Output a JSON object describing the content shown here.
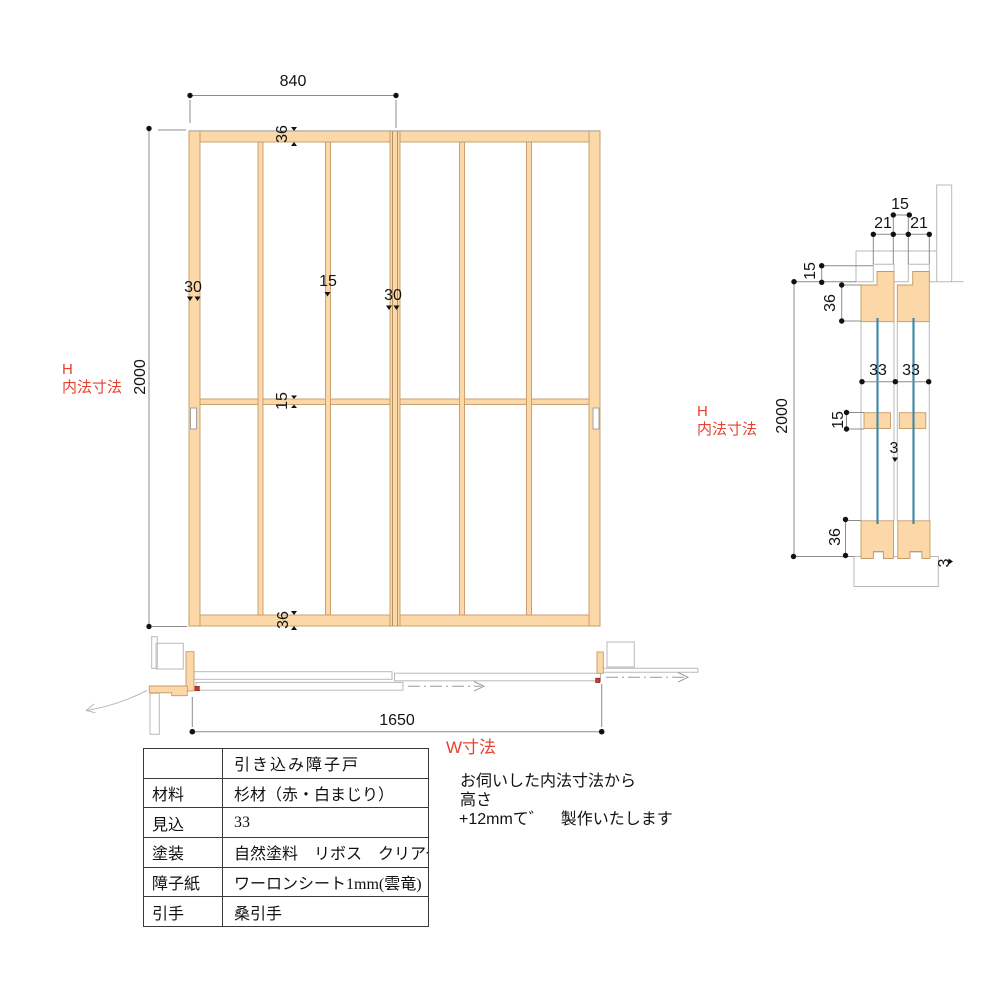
{
  "labels": {
    "h_left": {
      "line1": "H",
      "line2": "内法寸法"
    },
    "h_right": {
      "line1": "H",
      "line2": "内法寸法"
    },
    "w_label": "W寸法"
  },
  "elevation_dims": {
    "door_width": "840",
    "height": "2000",
    "top_rail": "36",
    "mid_rail": "15",
    "bottom_rail": "36",
    "left_stile": "30",
    "mullion": "15",
    "meeting_stile": "30"
  },
  "section_dims": {
    "track_gap_top": "15",
    "groove_left": "21",
    "groove_right": "21",
    "groove_depth": "15",
    "top_rail_height": "36",
    "door_thickness_left": "33",
    "door_thickness_right": "33",
    "height": "2000",
    "mid_rail_height": "15",
    "door_gap": "3",
    "bottom_rail_height": "36",
    "track_rail_height": "3"
  },
  "plan_dims": {
    "opening_width": "1650"
  },
  "note": {
    "line1": "お伺いした内法寸法から",
    "line2": "高さ",
    "line3": "+12mmて゛　製作いたします"
  },
  "spec_table": {
    "title": "引き込み障子戸",
    "rows": [
      {
        "label": "材料",
        "value": "杉材（赤・白まじり）"
      },
      {
        "label": "見込",
        "value": "33"
      },
      {
        "label": "塗装",
        "value": "自然塗料　リボス　クリアー"
      },
      {
        "label": "障子紙",
        "value": "ワーロンシート1mm(雲竜)"
      },
      {
        "label": "引手",
        "value": "桑引手"
      }
    ]
  },
  "colors": {
    "wood": "#FCD8A9",
    "accent_red": "#E8402E",
    "paper_blue": "#4789A8"
  }
}
